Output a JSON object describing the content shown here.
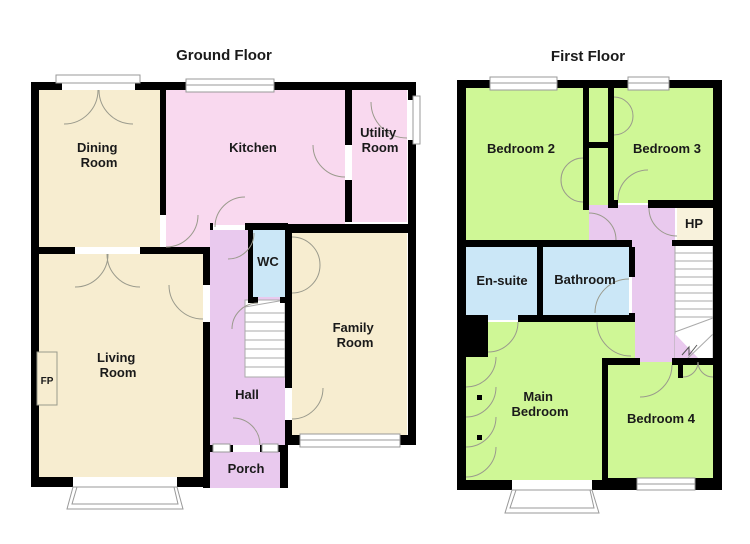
{
  "titles": {
    "ground": "Ground Floor",
    "first": "First Floor"
  },
  "colors": {
    "background": "#ffffff",
    "wall": "#000000",
    "cream": "#F7EDD0",
    "pink": "#F9D9EF",
    "purple": "#E9C9EE",
    "blue": "#CBE7F7",
    "green": "#CFF796",
    "hp_cream": "#F8F2DC",
    "door_line": "#9a9a8c",
    "window_line": "#999999",
    "stair_line": "#aaaaaa",
    "text": "#1a1a1a"
  },
  "ground": {
    "rooms": {
      "dining": {
        "line1": "Dining",
        "line2": "Room"
      },
      "kitchen": "Kitchen",
      "utility": {
        "line1": "Utility",
        "line2": "Room"
      },
      "wc": "WC",
      "family": {
        "line1": "Family",
        "line2": "Room"
      },
      "living": {
        "line1": "Living",
        "line2": "Room"
      },
      "hall": "Hall",
      "porch": "Porch",
      "fireplace": "FP"
    }
  },
  "first": {
    "rooms": {
      "bedroom2": "Bedroom 2",
      "bedroom3": "Bedroom 3",
      "hp": "HP",
      "ensuite": "En-suite",
      "bathroom": "Bathroom",
      "main_bedroom": {
        "line1": "Main",
        "line2": "Bedroom"
      },
      "bedroom4": "Bedroom 4"
    }
  }
}
